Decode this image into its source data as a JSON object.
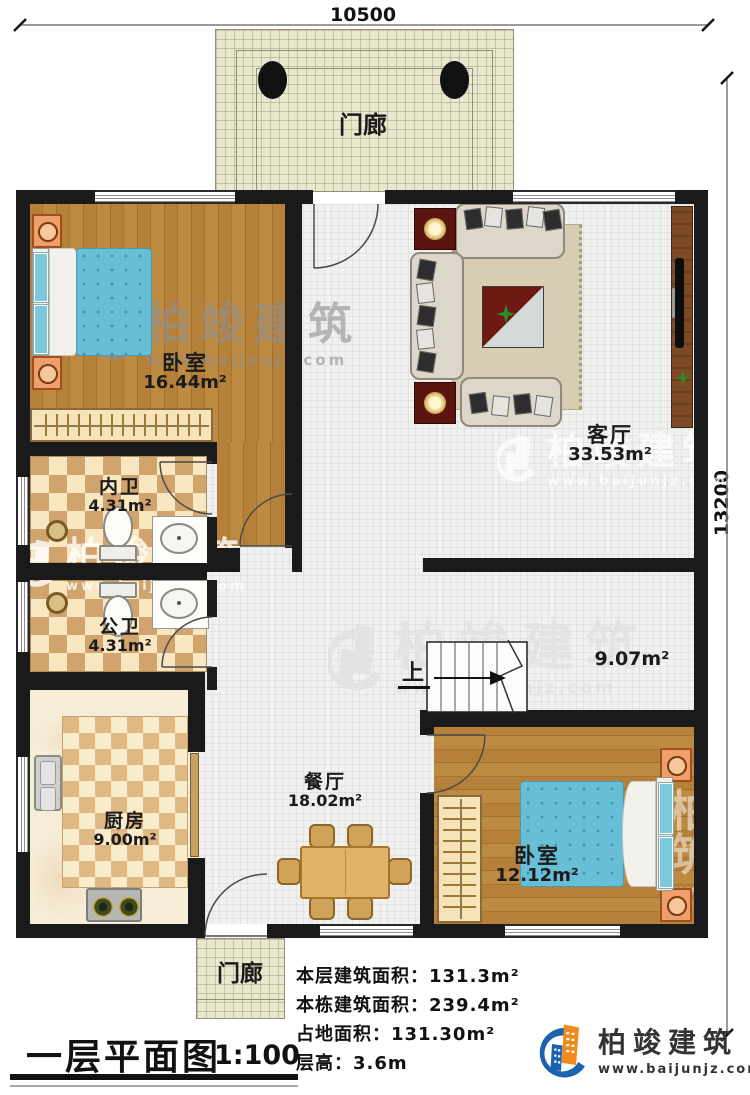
{
  "dimensions": {
    "top": "10500",
    "right": "13200"
  },
  "rooms": {
    "porch_top": {
      "name": "门廊"
    },
    "porch_bottom": {
      "name": "门廊"
    },
    "bedroom1": {
      "name": "卧室",
      "area": "16.44m²"
    },
    "living": {
      "name": "客厅",
      "area": "33.53m²"
    },
    "bath_inner": {
      "name": "内卫",
      "area": "4.31m²"
    },
    "bath_public": {
      "name": "公卫",
      "area": "4.31m²"
    },
    "kitchen": {
      "name": "厨房",
      "area": "9.00m²"
    },
    "dining": {
      "name": "餐厅",
      "area": "18.02m²"
    },
    "bedroom2": {
      "name": "卧室",
      "area": "12.12m²"
    },
    "stair_hall": {
      "up": "上",
      "area": "9.07m²"
    }
  },
  "title": {
    "name": "一层平面图",
    "scale": "1:100"
  },
  "info_lines": [
    {
      "label": "本层建筑面积：",
      "value": "131.3m²"
    },
    {
      "label": "本栋建筑面积：",
      "value": "239.4m²"
    },
    {
      "label": "占地面积：",
      "value": "131.30m²"
    },
    {
      "label": "层高：",
      "value": "3.6m"
    }
  ],
  "logo": {
    "title": "柏竣建筑",
    "url": "www.baijunjz.com"
  },
  "watermark": {
    "title": "柏竣建筑",
    "url": "www.baijunjz.com"
  }
}
